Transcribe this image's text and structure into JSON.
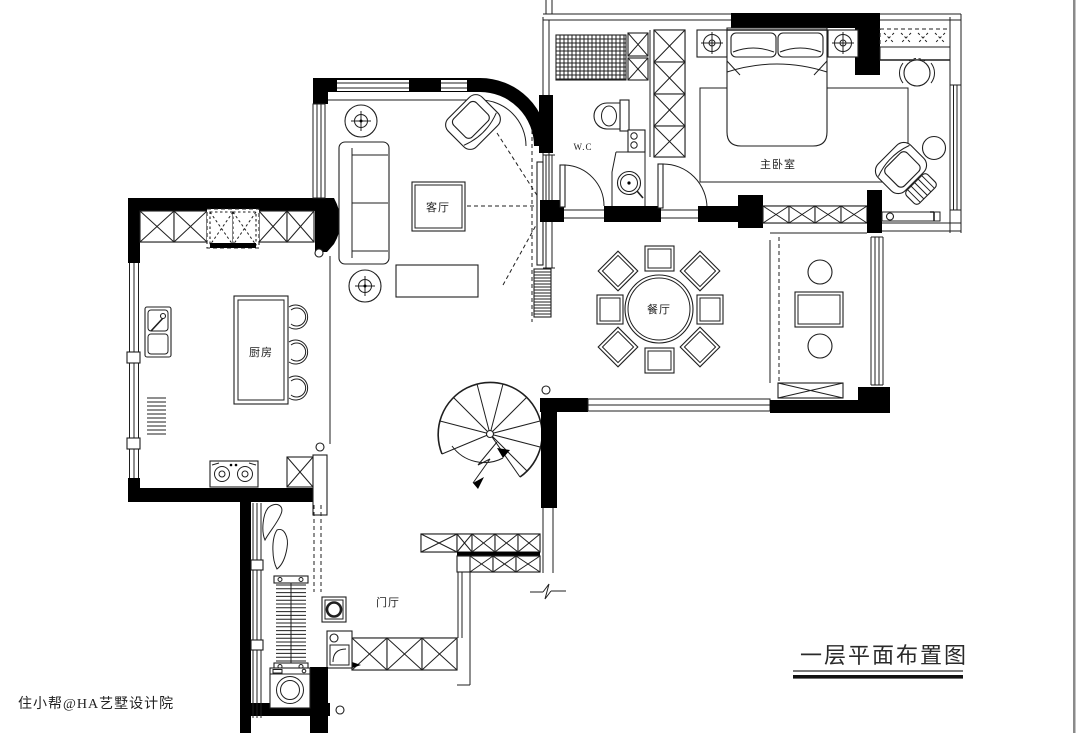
{
  "title": {
    "text": "一层平面布置图"
  },
  "watermark": {
    "text": "住小帮@HA艺墅设计院"
  },
  "rooms": {
    "living_room": {
      "label": "客厅"
    },
    "kitchen": {
      "label": "厨房"
    },
    "dining_room": {
      "label": "餐厅"
    },
    "master_bedroom": {
      "label": "主卧室"
    },
    "wc": {
      "label": "W.C"
    },
    "foyer": {
      "label": "门厅"
    }
  },
  "colors": {
    "wall": "#000000",
    "line": "#1f1f1f",
    "background": "#ffffff",
    "frame_border": "#8a8a8a",
    "watermark": "#e9e9e9"
  }
}
